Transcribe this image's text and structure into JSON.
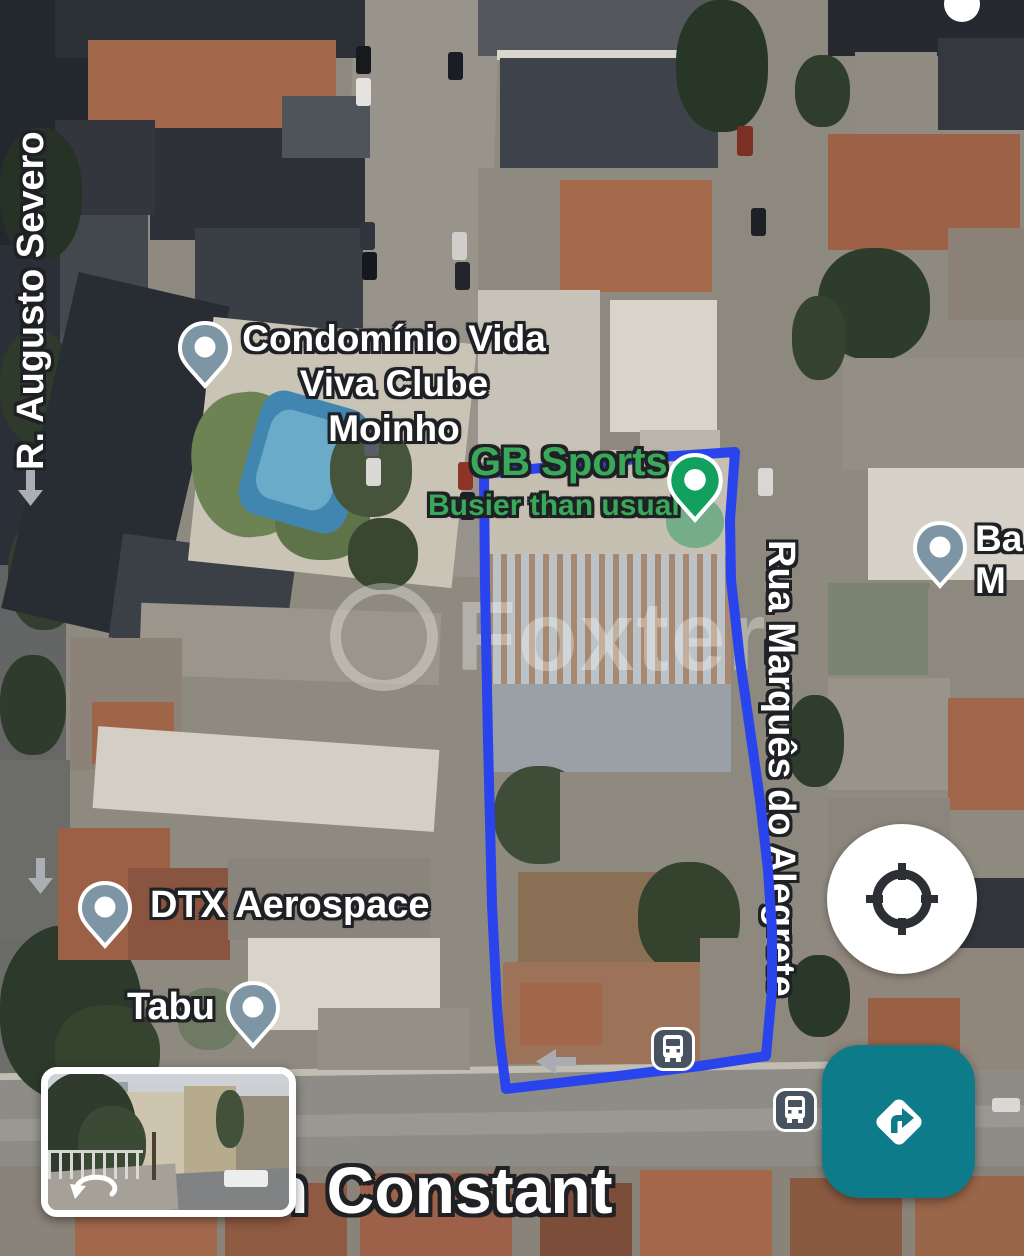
{
  "view": {
    "type": "satellite-map"
  },
  "streets": {
    "left": "R. Augusto Severo",
    "right": "Rua Marquês do Alegrete",
    "bottom": "n Constant"
  },
  "places": [
    {
      "id": "condominio-vida-viva",
      "line1": "Condomínio Vida",
      "line2": "Viva Clube Moinho",
      "pin_color": "#7e95a5"
    },
    {
      "id": "gb-sports",
      "label": "GB Sports",
      "status": "Busier than usual",
      "label_color": "#3aa85b",
      "pin_color": "#12a05f"
    },
    {
      "id": "dtx-aerospace",
      "label": "DTX Aerospace",
      "pin_color": "#7e95a5"
    },
    {
      "id": "tabu",
      "label": "Tabu",
      "pin_color": "#7e95a5"
    },
    {
      "id": "edge-partial",
      "line1": "Ba",
      "line2": "M",
      "pin_color": "#7e95a5"
    }
  ],
  "watermark": {
    "text": "Foxter"
  },
  "overlay": {
    "boundary_color": "#2944ec"
  },
  "controls": {
    "my_location": {
      "icon": "gps-crosshair-icon"
    },
    "directions": {
      "icon": "directions-arrow-icon",
      "color": "#0d7b89"
    },
    "street_view": {
      "icon": "rotate-view-icon"
    }
  },
  "transit": {
    "bus_icon_color": "#47545f",
    "bus_stop_count": 2
  }
}
